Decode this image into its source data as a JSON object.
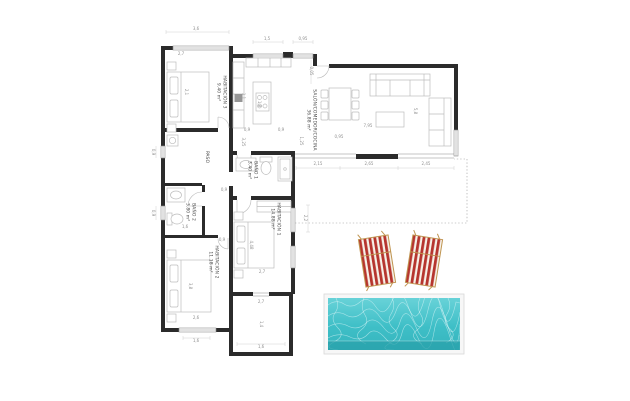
{
  "plan": {
    "rooms": [
      {
        "name": "HABITACIÓN 3",
        "area": "9.40 m²"
      },
      {
        "name": "SALÓN/COMEDOR/COCINA",
        "area": "36.88 m²"
      },
      {
        "name": "PASO",
        "area": ""
      },
      {
        "name": "BAÑO 1",
        "area": "3.40 m²"
      },
      {
        "name": "BAÑO 2",
        "area": "3.80 m²"
      },
      {
        "name": "HABITACIÓN 1",
        "area": "14.88 m²"
      },
      {
        "name": "HABITACIÓN 2",
        "area": "11.18 m²"
      }
    ],
    "dims": [
      "3,6",
      "2,7",
      "1,5",
      "0,95",
      "0,05",
      "1,8",
      "0,9",
      "0,9",
      "3,25",
      "1,25",
      "7,95",
      "0,95",
      "2,15",
      "2,65",
      "2,45",
      "5,8",
      "2,2",
      "2,7",
      "2,7",
      "1,4",
      "2,6",
      "1,6",
      "1,6",
      "0,9",
      "0,9",
      "2,1",
      "4,48",
      "3,8",
      "1,6",
      "0,9",
      "0,9",
      "1,1"
    ]
  },
  "exterior": {
    "pool": {
      "shape": "rectangle"
    },
    "loungers": {
      "count": 2
    }
  },
  "colors": {
    "background": "#ffffff",
    "wall": "#2b2b2b",
    "furniture_line": "#bdbdbd",
    "window_line": "#8a8a8a",
    "dimension_text": "#909090",
    "room_text": "#4a4a4a",
    "pool_frame": "#f7f7f7",
    "pool_water_light": "#68d2d8",
    "pool_water": "#3fbfc7",
    "pool_water_deep": "#2aa2ab",
    "lounger_red": "#b6352e",
    "lounger_canvas": "#f6f1e8",
    "lounger_wood": "#bf9450"
  }
}
